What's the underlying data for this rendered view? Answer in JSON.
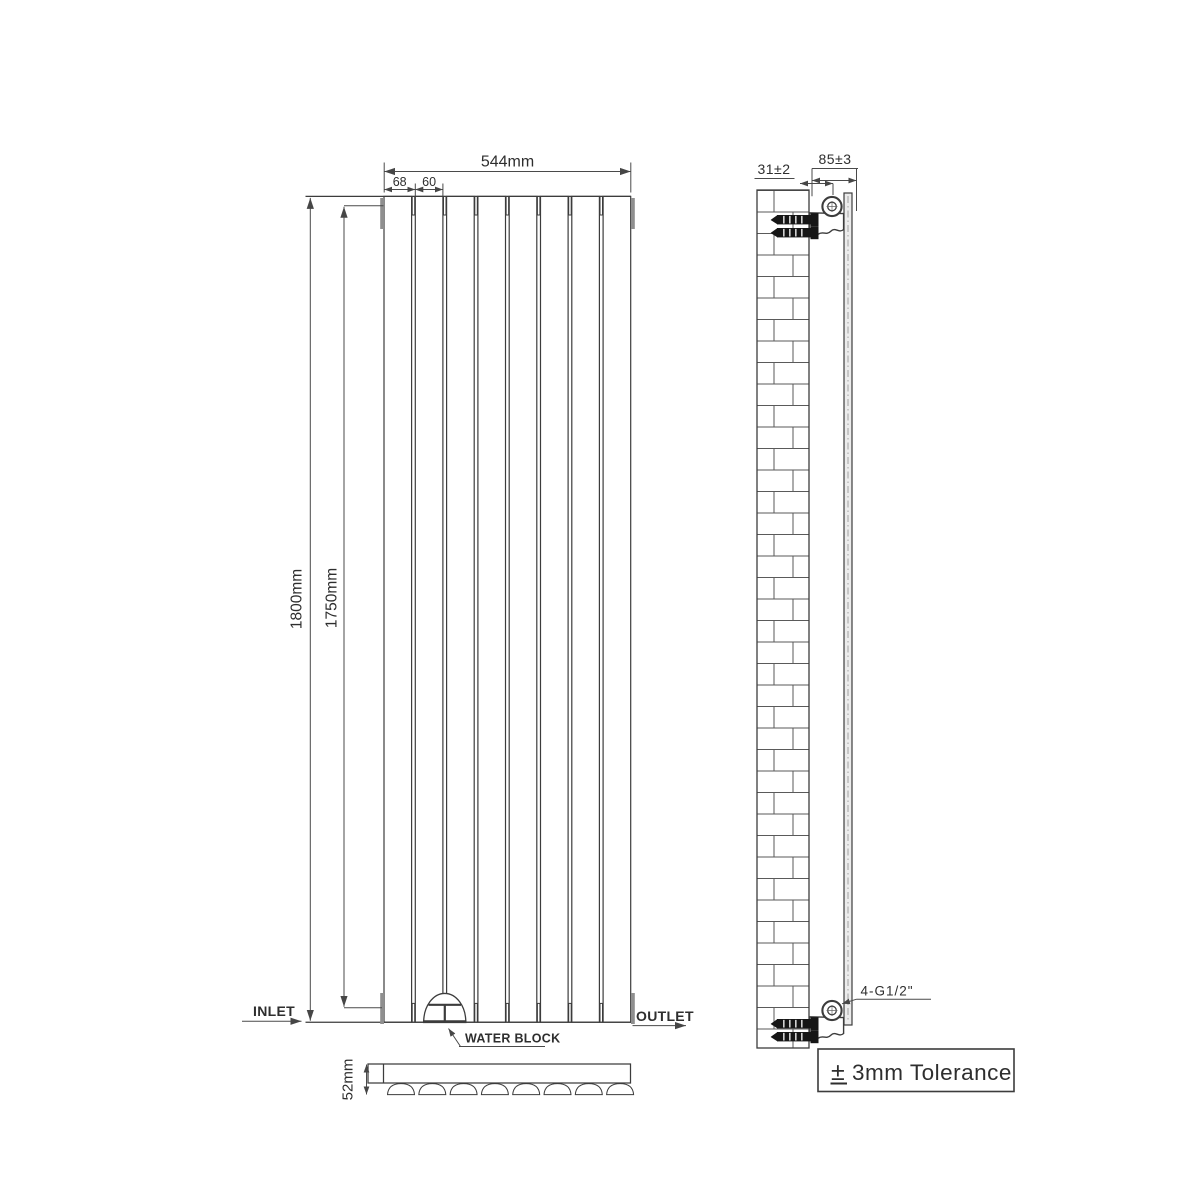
{
  "front": {
    "width": "544mm",
    "pitch": "68",
    "panel_width": "60",
    "height": "1800mm",
    "panel_height": "1750mm",
    "inlet": "INLET",
    "outlet": "OUTLET",
    "water_block": "WATER BLOCK"
  },
  "top": {
    "depth": "52mm"
  },
  "side": {
    "wall_gap": "31±2",
    "depth_from_wall": "85±3",
    "thread": "4-G1/2\"",
    "tolerance_sign": "±",
    "tolerance": "3mm Tolerance"
  },
  "colors": {
    "line": "#3c3c3c",
    "dim": "#4a4a4a",
    "text": "#2e2e2e",
    "tab": "#8f8f8f",
    "screw": "#161616",
    "panel-fill": "#ececec",
    "bg": "#ffffff"
  }
}
